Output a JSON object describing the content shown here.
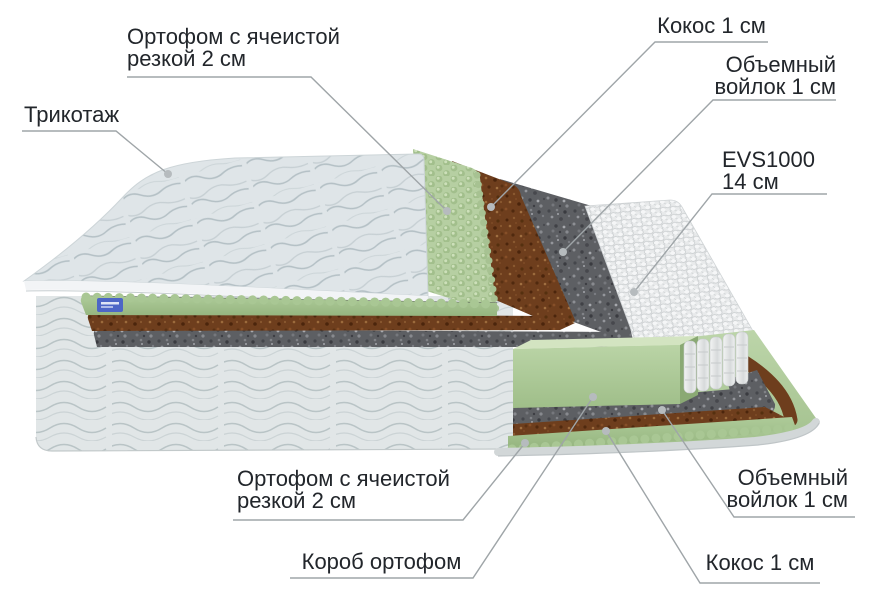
{
  "diagram_title": "Mattress layers cutaway infographic",
  "labels": {
    "ortofom_top": {
      "line1": "Ортофом с ячеистой",
      "line2": "резкой 2 см"
    },
    "trikotazh": {
      "text": "Трикотаж"
    },
    "kokos_top": {
      "text": "Кокос 1 см"
    },
    "voylok_top": {
      "line1": "Объемный",
      "line2": "войлок 1 см"
    },
    "evs": {
      "line1": "EVS1000",
      "line2": "14 см"
    },
    "ortofom_bottom": {
      "line1": "Ортофом с ячеистой",
      "line2": "резкой 2 см"
    },
    "korob": {
      "text": "Короб ортофом"
    },
    "voylok_bottom": {
      "line1": "Объемный",
      "line2": "войлок 1 см"
    },
    "kokos_bottom": {
      "text": "Кокос 1 см"
    }
  },
  "layers": [
    {
      "name": "knit-cover",
      "label_ref": "trikotazh"
    },
    {
      "name": "eggcrate-foam-top",
      "label_ref": "ortofom_top"
    },
    {
      "name": "coconut-coir-top",
      "label_ref": "kokos_top"
    },
    {
      "name": "felt-top",
      "label_ref": "voylok_top"
    },
    {
      "name": "spring-block",
      "label_ref": "evs"
    },
    {
      "name": "felt-bottom",
      "label_ref": "voylok_bottom"
    },
    {
      "name": "coconut-coir-bottom",
      "label_ref": "kokos_bottom"
    },
    {
      "name": "foam-box",
      "label_ref": "korob"
    },
    {
      "name": "eggcrate-foam-bottom",
      "label_ref": "ortofom_bottom"
    }
  ],
  "colors": {
    "text": "#22262b",
    "leader_line": "#9fa5a8",
    "leader_dot": "#b6bbbe",
    "quilt_fabric": "#dfe5e8",
    "body_side_fabric": "#e1e6e7",
    "eggcrate_green": "#b6cfa2",
    "coir_brown": "#6e3e1d",
    "felt_gray": "#5d5f63",
    "springs_white": "#e8eaeb",
    "rim_gray": "#d2d7d8",
    "tag_blue": "#4d66c6",
    "background": "#ffffff"
  }
}
